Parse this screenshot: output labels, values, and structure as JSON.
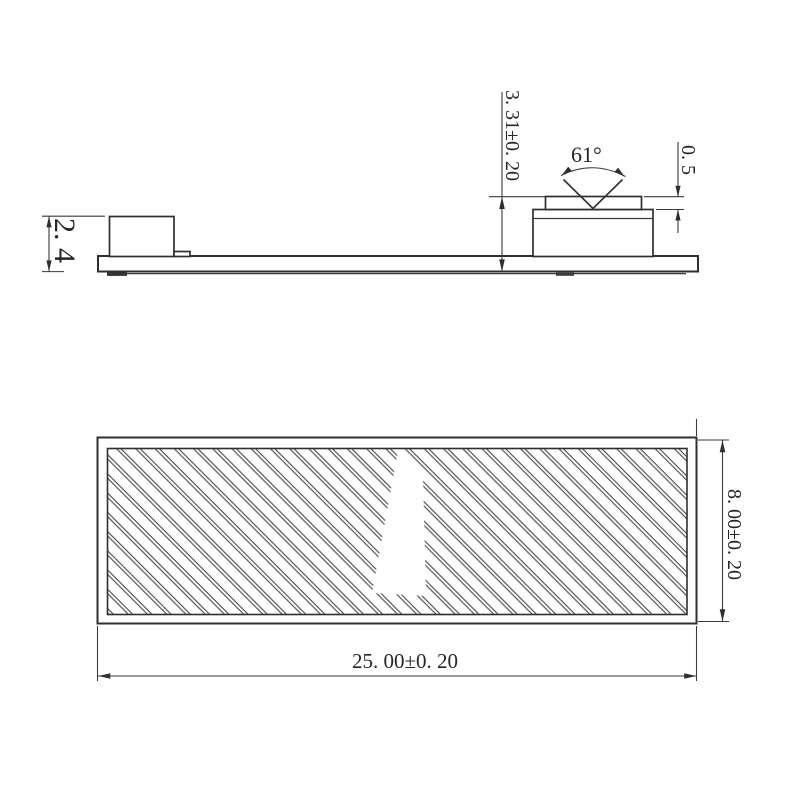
{
  "side_view": {
    "dim_left_height": "2. 4",
    "dim_component_height": "3. 31±0. 20",
    "dim_notch_angle": "61°",
    "dim_cap_height": "0. 5"
  },
  "bottom_view": {
    "dim_width": "8. 00±0. 20",
    "dim_length": "25. 00±0. 20"
  },
  "colors": {
    "background": "#ffffff",
    "outline": "#2f2f2f",
    "dimension_lines": "#3a3a3a",
    "hatch": "#4a4a4a"
  }
}
